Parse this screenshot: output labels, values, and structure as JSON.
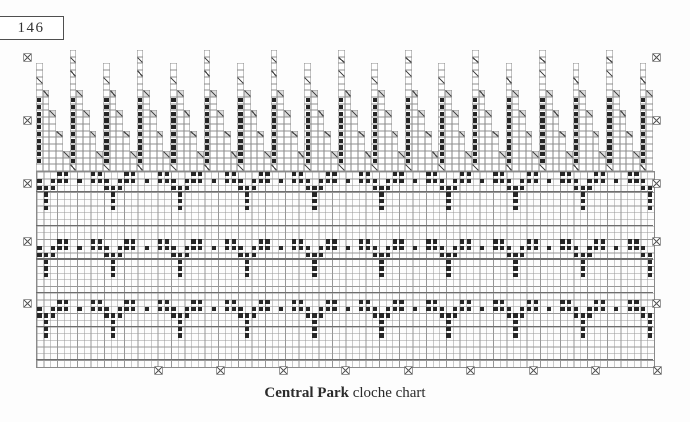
{
  "page": {
    "number": "146"
  },
  "caption": {
    "title": "Central Park",
    "subtitle": " cloche chart"
  },
  "chart_data": {
    "type": "knitting-chart",
    "title": "Central Park cloche chart",
    "grid": {
      "left": 36,
      "top": 50,
      "cell_w": 6.708,
      "cell_h": 6.72,
      "cols": 92,
      "staircase_rows": 18,
      "main_rows": 29,
      "bold_rows": [
        3,
        8,
        13,
        18,
        23,
        28
      ]
    },
    "staircase": {
      "tower_spacing_cols": 5,
      "tower_count": 19,
      "tall_top_row": 0,
      "short_top_row": 2,
      "tall_slash_rows": [
        1,
        3
      ],
      "short_slash_rows": [
        4
      ],
      "dark_rows": [
        7,
        16
      ],
      "steps": [
        [
          1,
          6
        ],
        [
          2,
          9
        ],
        [
          3,
          12
        ],
        [
          4,
          15
        ]
      ],
      "base_slash_row": 17
    },
    "motif": {
      "repeat_cols": 10,
      "first_center_col": 1,
      "band_start_rows": [
        0,
        10,
        19
      ],
      "rows": [
        {
          "dy": 0,
          "offsets": [
            -3,
            -2,
            2,
            3
          ]
        },
        {
          "dy": 1,
          "offsets": [
            -5,
            -3,
            -2,
            -1,
            1,
            2,
            3,
            5
          ]
        },
        {
          "dy": 2,
          "offsets": [
            -1,
            0,
            1
          ]
        },
        {
          "dy": 3,
          "offsets": [
            0
          ]
        },
        {
          "dy": 4,
          "offsets": [
            0
          ]
        },
        {
          "dy": 5,
          "offsets": [
            0
          ]
        }
      ]
    },
    "markers": {
      "left_x": 27,
      "right_x": 656,
      "edge_ys": [
        57,
        120,
        183,
        241,
        303
      ],
      "bottom_y": 370,
      "bottom_xs": [
        158,
        220,
        283,
        345,
        408,
        470,
        533,
        595,
        657
      ]
    },
    "colors": {
      "grid_line": "#979797",
      "bold_line": "#6d6d6d",
      "cell_border": "#8f8f8f",
      "stitch_dot": "#262626",
      "slash": "#4a4a4a",
      "slash_shade": "#dcdcdc",
      "marker": "#6f6f6f",
      "text": "#2b2b2b"
    }
  }
}
